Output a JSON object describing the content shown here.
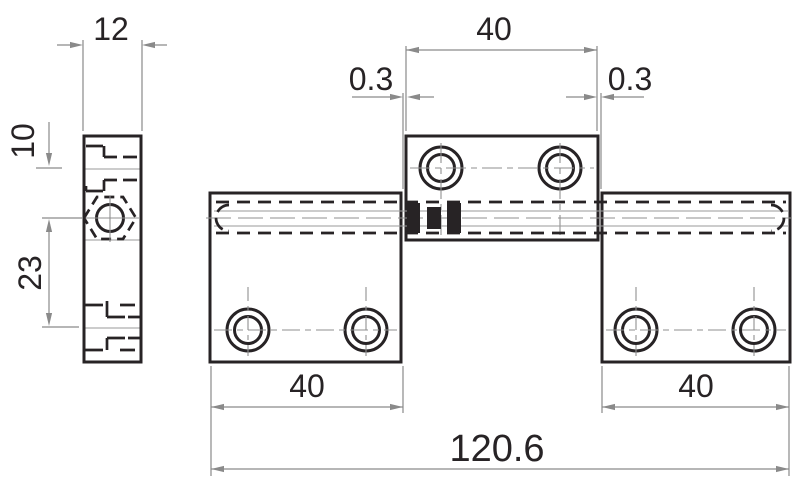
{
  "meta": {
    "drawing_type": "technical-drawing",
    "background_color": "#ffffff",
    "line_color": "#272325",
    "dimension_color": "#8a8a8a"
  },
  "views": {
    "side_view": {
      "dimensions": [
        {
          "id": "plate-thickness",
          "label": "12"
        },
        {
          "id": "top-hole-offset",
          "label": "10"
        },
        {
          "id": "pin-to-hole-spacing",
          "label": "23"
        }
      ]
    },
    "front_view": {
      "dimensions": [
        {
          "id": "center-knuckle-width",
          "label": "40"
        },
        {
          "id": "clearance-left",
          "label": "0.3"
        },
        {
          "id": "clearance-right",
          "label": "0.3"
        },
        {
          "id": "left-leaf-width",
          "label": "40"
        },
        {
          "id": "right-leaf-width",
          "label": "40"
        },
        {
          "id": "overall-width",
          "label": "120.6"
        }
      ]
    }
  }
}
